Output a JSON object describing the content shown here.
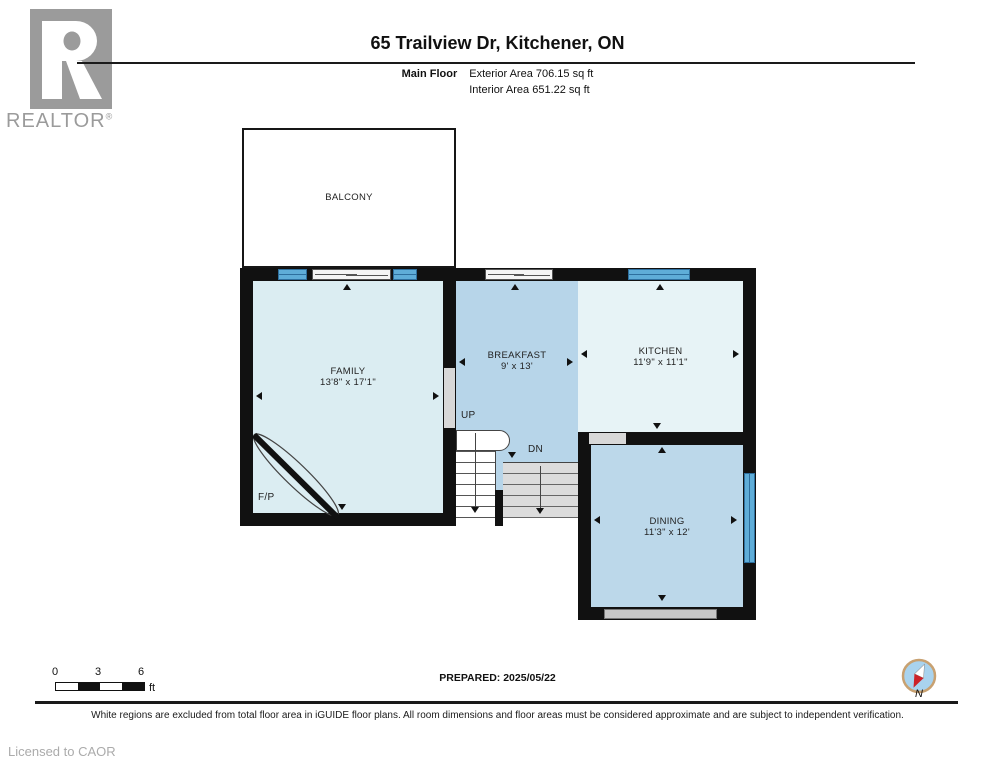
{
  "header": {
    "title": "65 Trailview Dr, Kitchener, ON",
    "floor_label": "Main Floor",
    "exterior_area": "Exterior Area 706.15 sq ft",
    "interior_area": "Interior Area 651.22 sq ft"
  },
  "logo": {
    "wordmark": "REALTOR",
    "registered_mark": "®"
  },
  "floorplan": {
    "rooms": {
      "balcony": {
        "name": "BALCONY"
      },
      "family": {
        "name": "FAMILY",
        "dims": "13'8\" x 17'1\""
      },
      "breakfast": {
        "name": "BREAKFAST",
        "dims": "9' x 13'"
      },
      "kitchen": {
        "name": "KITCHEN",
        "dims": "11'9\" x 11'1\""
      },
      "dining": {
        "name": "DINING",
        "dims": "11'3\" x 12'"
      }
    },
    "annotations": {
      "up": "UP",
      "down": "DN",
      "fireplace": "F/P"
    }
  },
  "scale_bar": {
    "tick_0": "0",
    "tick_3": "3",
    "tick_6": "6",
    "unit": "ft"
  },
  "footer": {
    "prepared": "PREPARED: 2025/05/22",
    "compass_label": "N",
    "disclaimer": "White regions are excluded from total floor area in iGUIDE floor plans. All room dimensions and floor areas must be considered approximate and are subject to independent verification.",
    "licensed_to": "Licensed to CAOR"
  },
  "colors": {
    "wall": "#111111",
    "family_fill": "#dbedf2",
    "breakfast_fill": "#b7d5e9",
    "kitchen_fill": "#e7f3f6",
    "dining_fill": "#bcd8ea",
    "window": "#5fadd8",
    "stair_gray": "#dcdcdc",
    "logo_gray": "#9b9b9b"
  }
}
